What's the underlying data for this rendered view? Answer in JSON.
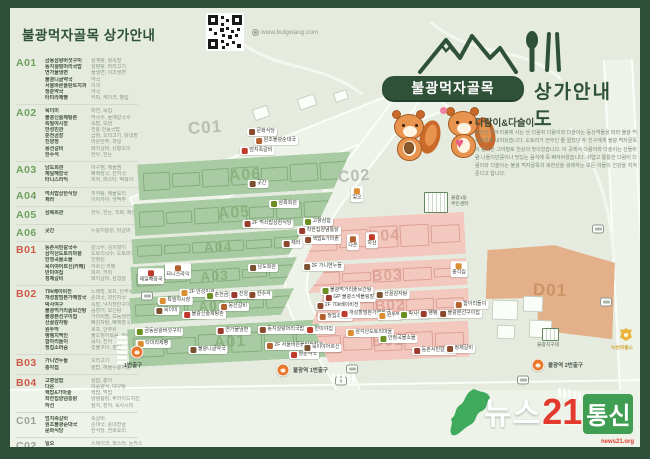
{
  "header": {
    "title": "불광먹자골목 상가안내",
    "website": "www.bulgwang.com"
  },
  "logo": {
    "badge": "불광먹자골목",
    "suffix": "상가안내도"
  },
  "mascot": {
    "title": "다람이&다슬이",
    "body": "북한산 족두리봉에 사는 산 다람쥐 다람이와 다슬이는 등산객들을 따라 불광 먹자골목에 내려왔습니다. 도토리가 전부인 줄 알았던 두 친구에게 불광 먹자골목의 음식은 그야말로 천상의 맛이었습니다. 이 곳에서 다람이와 다슬이는 산들바람 나들이만큼이나 맛있는 음식에 푹 빠져버렸습니다. 귀엽고 통통한 다람이 다람이와 다슬이는 불광 먹자골목과 북한산을 왕래하는 모든 이들의 건강을 지켜준다고 합니다."
  },
  "colors": {
    "frame": "#2e4f37",
    "ground": "#e5ecdf",
    "road": "#eef3ea",
    "green_fill": "#a9cba3",
    "green_line": "#85ad7c",
    "green_label": "#86b07c",
    "pink_fill": "#f3c8bf",
    "pink_line": "#dda094",
    "pink_label": "#dc9f92",
    "tan_fill": "#e3b08a",
    "tan_line": "#cb9063",
    "tan_label": "#c78f60",
    "code_a": "#6fa05e",
    "code_b": "#cf5948",
    "code_c": "#9aa29a",
    "code_d": "#d0703f",
    "subway": "#e8792f",
    "watermark_green": "#3fa95c",
    "watermark_red": "#e23b2e"
  },
  "directory": {
    "sections": [
      {
        "code": "A01",
        "color": "#6fa05e",
        "items": [
          {
            "name": "금동삼왕버섯구이",
            "desc": "삼계탕, 왕족발"
          },
          {
            "name": "동지설렁머리국밥",
            "desc": "설렁탕, 머리고기"
          },
          {
            "name": "연가물냉면",
            "desc": "물냉면, 이조냉면"
          },
          {
            "name": "불광니글약국",
            "desc": "약국"
          },
          {
            "name": "서울바른플란트치과",
            "desc": "치과"
          },
          {
            "name": "청춘약국",
            "desc": "약국"
          },
          {
            "name": "타미라제빵",
            "desc": "커피, 케이크, 빵집"
          }
        ]
      },
      {
        "code": "A02",
        "color": "#6fa05e",
        "items": [
          {
            "name": "묵더미",
            "desc": "파전, 묵집"
          },
          {
            "name": "불광신술제탕촌",
            "desc": "막국수, 들깨칼국수"
          },
          {
            "name": "특밀야시장",
            "desc": "족발, 보쌈"
          },
          {
            "name": "안성민관",
            "desc": "전통 안동국밥"
          },
          {
            "name": "춘천곰장",
            "desc": "곱창, 오리고기, 닭내장"
          },
          {
            "name": "진양정",
            "desc": "마른안주, 과일"
          },
          {
            "name": "몽선갈비",
            "desc": "돼지갈비, 유황오리"
          },
          {
            "name": "한수석",
            "desc": "한우, 한돈"
          }
        ]
      },
      {
        "code": "A03",
        "color": "#6fa05e",
        "items": [
          {
            "name": "남도회관",
            "desc": "아구찜, 해물찜"
          },
          {
            "name": "제일해장국",
            "desc": "뼈해장국, 선지국"
          },
          {
            "name": "타니스라익",
            "desc": "피자, 파스타, 떡볶이"
          }
        ]
      },
      {
        "code": "A04",
        "color": "#6fa05e",
        "items": [
          {
            "name": "먹쇠밥상한식당",
            "desc": "추어탕, 해물요리"
          },
          {
            "name": "제라",
            "desc": "이자카야, 생맥주"
          }
        ]
      },
      {
        "code": "A05",
        "color": "#6fa05e",
        "items": [
          {
            "name": "삼록회관",
            "desc": "한우, 한돈, 직화, 해산물"
          }
        ]
      },
      {
        "code": "A06",
        "color": "#6fa05e",
        "items": [
          {
            "name": "곳간",
            "desc": "누룽지통닭, 닭갈비"
          }
        ]
      },
      {
        "code": "B01",
        "color": "#cf5948",
        "items": [
          {
            "name": "둥촌서민칼국수",
            "desc": "칼국수, 김치말이"
          },
          {
            "name": "삼각산도토리마을",
            "desc": "도토리국수, 도토리묵"
          },
          {
            "name": "안정곡물소믈",
            "desc": "안정원"
          },
          {
            "name": "묵이야어르신(카페)",
            "desc": "어르신 카페"
          },
          {
            "name": "반미야집",
            "desc": "피자, 커피"
          },
          {
            "name": "정제갈비",
            "desc": "돼지갈비, 삼겹살"
          }
        ]
      },
      {
        "code": "B02",
        "color": "#cf5948",
        "items": [
          {
            "name": "70k베이비전",
            "desc": "노래방, 호프, 안주류"
          },
          {
            "name": "개성할멈본가해장국",
            "desc": "순대국, 양선지국"
          },
          {
            "name": "박사여구",
            "desc": "족발, 낙지쟁반구이"
          },
          {
            "name": "불광먹거리솥브간탕",
            "desc": "꼼장어, 보신탕"
          },
          {
            "name": "불광본선구이집",
            "desc": "가리비찜, 모둠생선찜"
          },
          {
            "name": "산꿀감자탕",
            "desc": "뼈감자탕, 뼈해장국"
          },
          {
            "name": "원두막",
            "desc": "호프, 안주류"
          },
          {
            "name": "뱅뱅치멕인",
            "desc": "불오징어볶음, 안주"
          },
          {
            "name": "함아리들이",
            "desc": "묵이, 전어"
          },
          {
            "name": "정집소머슴",
            "desc": "숯불구이, 쌈밥"
          }
        ]
      },
      {
        "code": "B03",
        "color": "#cf5948",
        "items": [
          {
            "name": "가니연누들",
            "desc": "오리고기"
          },
          {
            "name": "총각집",
            "desc": "쌀밥, 해물누룽지탕"
          }
        ]
      },
      {
        "code": "B04",
        "color": "#cf5948",
        "items": [
          {
            "name": "고향삼합",
            "desc": "삼합, 홍어"
          },
          {
            "name": "다온",
            "desc": "대중양식, 대구탕"
          },
          {
            "name": "핵밥&가마솥",
            "desc": "핵밥, 먹밥"
          },
          {
            "name": "착한집양념통닭",
            "desc": "양념통닭, 후라이드치킨"
          },
          {
            "name": "하선",
            "desc": "참치, 장어, 육사시미"
          }
        ]
      },
      {
        "code": "C01",
        "color": "#9aa29a",
        "items": [
          {
            "name": "엄지족갈비",
            "desc": "족갈비"
          },
          {
            "name": "원조불광순대국",
            "desc": "순대국, 순대전골"
          },
          {
            "name": "문화식당",
            "desc": "한식당, 전복요리"
          }
        ]
      },
      {
        "code": "C02",
        "color": "#9aa29a",
        "items": [
          {
            "name": "일오",
            "desc": "스테이크, 파스타, 돈카스"
          }
        ]
      },
      {
        "code": "D01",
        "color": "#d0703f",
        "items": [
          {
            "name": "미도커피",
            "desc": "커피, 생과자"
          }
        ]
      }
    ]
  },
  "map": {
    "street_labels": [
      {
        "text": "C01",
        "x": 178,
        "y": 110,
        "size": 17
      },
      {
        "text": "C02",
        "x": 328,
        "y": 160,
        "size": 16
      }
    ],
    "blocks": [
      {
        "id": "A06",
        "x": 128,
        "y": 150,
        "w": 214,
        "h": 36,
        "rot": -3.5,
        "kind": "green",
        "cut": "right",
        "n": 7,
        "lsize": 16
      },
      {
        "id": "A05",
        "x": 124,
        "y": 190,
        "w": 200,
        "h": 32,
        "rot": -3.5,
        "kind": "green",
        "cut": "right",
        "n": 7,
        "lsize": 16
      },
      {
        "id": "A04",
        "x": 122,
        "y": 226,
        "w": 172,
        "h": 25,
        "rot": -3.5,
        "kind": "green",
        "cut": "right",
        "n": 6,
        "lsize": 14
      },
      {
        "id": "A03",
        "x": 121,
        "y": 254,
        "w": 167,
        "h": 27,
        "rot": -3.5,
        "kind": "green",
        "cut": "right",
        "n": 6,
        "lsize": 14
      },
      {
        "id": "A02",
        "x": 120,
        "y": 285,
        "w": 165,
        "h": 26,
        "rot": -3.5,
        "kind": "green",
        "cut": "right",
        "n": 6,
        "lsize": 14
      },
      {
        "id": "A01",
        "x": 118,
        "y": 316,
        "w": 204,
        "h": 38,
        "rot": -3,
        "kind": "green",
        "cut": "rightout",
        "n": 6,
        "lsize": 16
      },
      {
        "id": "B04",
        "x": 293,
        "y": 208,
        "w": 162,
        "h": 42,
        "rot": -3,
        "kind": "pink",
        "cut": "left",
        "n": 5,
        "lsize": 16
      },
      {
        "id": "B03",
        "x": 297,
        "y": 254,
        "w": 160,
        "h": 27,
        "rot": -3,
        "kind": "pink",
        "cut": "left",
        "n": 5,
        "lsize": 15
      },
      {
        "id": "B02",
        "x": 301,
        "y": 284,
        "w": 158,
        "h": 28,
        "rot": -3,
        "kind": "pink",
        "cut": "left2",
        "n": 5,
        "lsize": 15
      },
      {
        "id": "B01",
        "x": 297,
        "y": 316,
        "w": 162,
        "h": 36,
        "rot": -2.5,
        "kind": "pink",
        "cut": "leftout",
        "n": 5,
        "lsize": 16
      },
      {
        "id": "D01",
        "x": 476,
        "y": 237,
        "w": 128,
        "h": 92,
        "rot": 2,
        "kind": "tan",
        "cut": "dshape",
        "n": 0,
        "lsize": 17
      }
    ],
    "markers": [
      {
        "label": "문화식당",
        "x": 252,
        "y": 124
      },
      {
        "label": "원조불광순대국",
        "x": 266,
        "y": 133
      },
      {
        "label": "엄지족갈비",
        "x": 247,
        "y": 143
      },
      {
        "label": "곳간",
        "x": 248,
        "y": 176
      },
      {
        "label": "일오",
        "x": 347,
        "y": 186,
        "below": true
      },
      {
        "label": "삼록회관",
        "x": 274,
        "y": 196
      },
      {
        "label": "2F 먹쇠밥상한식당",
        "x": 258,
        "y": 216
      },
      {
        "label": "제라",
        "x": 282,
        "y": 236
      },
      {
        "label": "타니스라익",
        "x": 168,
        "y": 263,
        "below": true
      },
      {
        "label": "제일해장국",
        "x": 141,
        "y": 268,
        "below": true
      },
      {
        "label": "남도회관",
        "x": 253,
        "y": 260
      },
      {
        "label": "2F 안성민관",
        "x": 188,
        "y": 285
      },
      {
        "label": "춘천곰장",
        "x": 210,
        "y": 288
      },
      {
        "label": "진양정",
        "x": 232,
        "y": 287
      },
      {
        "label": "한수석",
        "x": 250,
        "y": 287
      },
      {
        "label": "몽선갈비",
        "x": 224,
        "y": 299
      },
      {
        "label": "불광신술제탕촌",
        "x": 194,
        "y": 307
      },
      {
        "label": "묵더미",
        "x": 157,
        "y": 303
      },
      {
        "label": "특밀야시장",
        "x": 165,
        "y": 293
      },
      {
        "label": "금동삼왕버섯구이",
        "x": 149,
        "y": 324
      },
      {
        "label": "연가물냉면",
        "x": 223,
        "y": 323
      },
      {
        "label": "동지설렁머리국밥",
        "x": 272,
        "y": 322
      },
      {
        "label": "2F 서울바른플란트치과",
        "x": 285,
        "y": 338
      },
      {
        "label": "청춘약국",
        "x": 294,
        "y": 347
      },
      {
        "label": "불광니글약국",
        "x": 198,
        "y": 342
      },
      {
        "label": "타미라제빵",
        "x": 143,
        "y": 336
      },
      {
        "label": "고향삼합",
        "x": 308,
        "y": 214
      },
      {
        "label": "착한집양념통닭",
        "x": 309,
        "y": 223
      },
      {
        "label": "핵밥&가마솥",
        "x": 312,
        "y": 232
      },
      {
        "label": "다온",
        "x": 343,
        "y": 234,
        "below": true
      },
      {
        "label": "하선",
        "x": 362,
        "y": 232,
        "below": true
      },
      {
        "label": "2F 가니연누들",
        "x": 313,
        "y": 259
      },
      {
        "label": "총각집",
        "x": 449,
        "y": 261,
        "below": true
      },
      {
        "label": "불광먹거리솥브간탕",
        "x": 337,
        "y": 283
      },
      {
        "label": "GP 불광스낵볼링장",
        "x": 340,
        "y": 290
      },
      {
        "label": "2F 70k베이비전",
        "x": 328,
        "y": 298
      },
      {
        "label": "정집소머슴",
        "x": 325,
        "y": 309
      },
      {
        "label": "개성할멈본가해장국",
        "x": 356,
        "y": 306
      },
      {
        "label": "산꿀감자탕",
        "x": 382,
        "y": 287
      },
      {
        "label": "원두막",
        "x": 380,
        "y": 308
      },
      {
        "label": "박사여구",
        "x": 404,
        "y": 307
      },
      {
        "label": "뱅뱅치멕인",
        "x": 426,
        "y": 306
      },
      {
        "label": "불광본선구이집",
        "x": 450,
        "y": 306
      },
      {
        "label": "함아리들이",
        "x": 461,
        "y": 297
      },
      {
        "label": "반미야집",
        "x": 310,
        "y": 322
      },
      {
        "label": "묵이야어르신",
        "x": 312,
        "y": 340
      },
      {
        "label": "삼각산도토리마을",
        "x": 360,
        "y": 325
      },
      {
        "label": "안정곡물소믈",
        "x": 388,
        "y": 331
      },
      {
        "label": "둥촌서민칼국수",
        "x": 424,
        "y": 343
      },
      {
        "label": "정제갈비",
        "x": 450,
        "y": 341
      }
    ],
    "landmarks": {
      "community_center": {
        "label1": "불광1동",
        "label2": "주민센터",
        "x": 414,
        "y": 184
      },
      "police_box": {
        "label": "녹번파출소",
        "x": 612,
        "y": 322
      },
      "police_sub": {
        "label": "불광지구대",
        "x": 540,
        "y": 320
      },
      "subway_exits": [
        {
          "label": "불광역 1번출구",
          "cx": 273,
          "cy": 362,
          "lx": 283,
          "ly": 358
        },
        {
          "label": "1번출구",
          "cx": 127,
          "cy": 344,
          "lx": 114,
          "ly": 353
        },
        {
          "label": "불광역 2번출구",
          "cx": 528,
          "cy": 357,
          "lx": 538,
          "ly": 353
        }
      ],
      "buses": [
        {
          "x": 137,
          "y": 288
        },
        {
          "x": 342,
          "y": 361
        },
        {
          "x": 331,
          "y": 373
        },
        {
          "x": 588,
          "y": 221
        },
        {
          "x": 596,
          "y": 294
        },
        {
          "x": 513,
          "y": 372
        }
      ],
      "crosswalks": [
        {
          "x": 107,
          "y": 328,
          "n": 6,
          "bw": 10,
          "bh": 2.5,
          "dx": 0,
          "dy": 5
        },
        {
          "x": 322,
          "y": 366,
          "n": 5,
          "bw": 2.5,
          "bh": 9,
          "dx": 5,
          "dy": 0
        },
        {
          "x": 548,
          "y": 380,
          "n": 5,
          "bw": 2.5,
          "bh": 9,
          "dx": 5,
          "dy": 1
        }
      ],
      "decor": [
        {
          "x": 243,
          "y": 99,
          "w": 16,
          "h": 12,
          "rot": -19
        },
        {
          "x": 288,
          "y": 88,
          "w": 18,
          "h": 12,
          "rot": -19
        },
        {
          "x": 324,
          "y": 83,
          "w": 14,
          "h": 10,
          "rot": -19
        },
        {
          "x": 482,
          "y": 292,
          "w": 26,
          "h": 20,
          "rot": 2
        },
        {
          "x": 513,
          "y": 288,
          "w": 20,
          "h": 16,
          "rot": 2
        },
        {
          "x": 487,
          "y": 317,
          "w": 18,
          "h": 14,
          "rot": 2
        },
        {
          "x": 519,
          "y": 312,
          "w": 23,
          "h": 18,
          "rot": 2
        }
      ]
    }
  },
  "watermark": {
    "part1": "뉴스",
    "part2": "21",
    "part3": "통신",
    "sub": "news21.org"
  }
}
